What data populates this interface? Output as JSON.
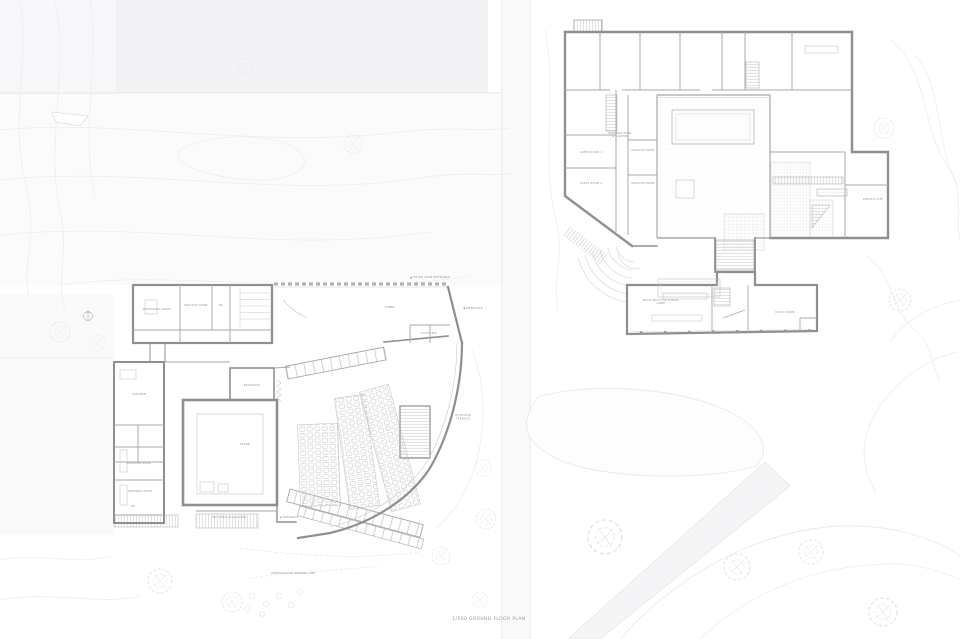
{
  "caption": {
    "text": "1/500 GROUND FLOOR PLAN"
  },
  "colors": {
    "background": "#ffffff",
    "wall": "#8f8f92",
    "partition": "#a8a8ab",
    "fine_line": "#c9c9cc",
    "site_line": "#e9e9ec",
    "site_fill": "#f3f3f5",
    "hatch": "#bfbfc2",
    "label": "#8d8d92"
  },
  "labels": [
    {
      "name": "rehearsal-room",
      "text": "REHEARSAL ROOM",
      "x": 157,
      "y": 310,
      "size": 2.6
    },
    {
      "name": "practice-room",
      "text": "PRACTICE ROOM",
      "x": 196,
      "y": 306,
      "size": 2.4
    },
    {
      "name": "wc-north",
      "text": "WC",
      "x": 221,
      "y": 306,
      "size": 2.4
    },
    {
      "name": "lobby",
      "text": "LOBBY",
      "x": 390,
      "y": 308,
      "size": 2.8
    },
    {
      "name": "foyer-main-entrance",
      "text": "▲ FOYER MAIN ENTRANCE",
      "x": 430,
      "y": 278,
      "size": 2.7
    },
    {
      "name": "entrance-east",
      "text": "◀ ENTRANCE",
      "x": 473,
      "y": 309,
      "size": 2.7
    },
    {
      "name": "ticket-box",
      "text": "TICKET BOX",
      "x": 429,
      "y": 334,
      "size": 2.4
    },
    {
      "name": "backstage",
      "text": "BACKSTAGE",
      "x": 252,
      "y": 386,
      "size": 2.4
    },
    {
      "name": "stage",
      "text": "STAGE",
      "x": 245,
      "y": 445,
      "size": 2.8
    },
    {
      "name": "outdoor-terrace",
      "text": "OUTDOOR\nTERRACE",
      "x": 463,
      "y": 416,
      "size": 2.7
    },
    {
      "name": "canteen",
      "text": "CANTEEN",
      "x": 139,
      "y": 395,
      "size": 2.6
    },
    {
      "name": "dressing-room-1",
      "text": "DRESSING ROOM",
      "x": 139,
      "y": 464,
      "size": 2.4
    },
    {
      "name": "dressing-room-2",
      "text": "DRESSING ROOM",
      "x": 140,
      "y": 492,
      "size": 2.4
    },
    {
      "name": "wc-west",
      "text": "WC",
      "x": 133,
      "y": 507,
      "size": 2.4
    },
    {
      "name": "music-plaza",
      "text": "THE MUSIC PLAZA PARK",
      "x": 229,
      "y": 518,
      "size": 2.5
    },
    {
      "name": "entrance-south",
      "text": "◀ ENTRANCE",
      "x": 289,
      "y": 518,
      "size": 2.5
    },
    {
      "name": "underground-parking",
      "text": "UNDERGROUND PARKING LINE",
      "x": 293,
      "y": 574,
      "size": 2.5
    },
    {
      "name": "guest-room-1",
      "text": "GUEST ROOM 1",
      "x": 591,
      "y": 153,
      "size": 2.5
    },
    {
      "name": "guest-room-2",
      "text": "GUEST ROOM 2",
      "x": 591,
      "y": 184,
      "size": 2.5
    },
    {
      "name": "dressing-lockers",
      "text": "DRESSING ROOM\n& LOCKERS",
      "x": 620,
      "y": 134,
      "size": 2.3
    },
    {
      "name": "practice-room-1",
      "text": "PRACTICE ROOM",
      "x": 643,
      "y": 151,
      "size": 2.4
    },
    {
      "name": "practice-room-2",
      "text": "PRACTICE ROOM",
      "x": 643,
      "y": 184,
      "size": 2.4
    },
    {
      "name": "artists-cafe",
      "text": "ARTISTS CAFE",
      "x": 873,
      "y": 200,
      "size": 2.5
    },
    {
      "name": "music-school-lobby",
      "text": "MUSIC PRACTICE SCHOOL\nLOBBY",
      "x": 661,
      "y": 301,
      "size": 2.4
    },
    {
      "name": "music-room",
      "text": "MUSIC ROOM",
      "x": 785,
      "y": 313,
      "size": 2.5
    }
  ]
}
